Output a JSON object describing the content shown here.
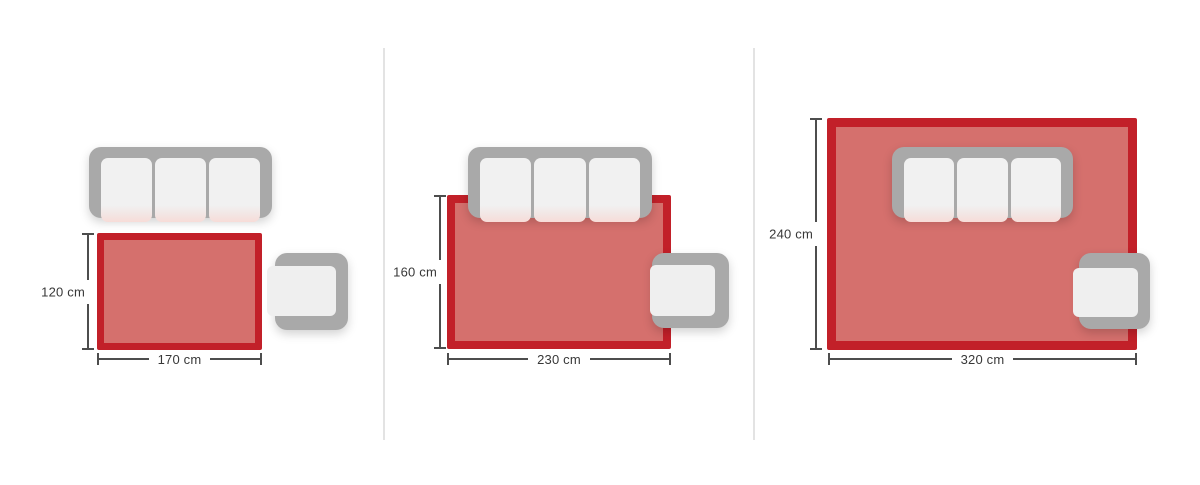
{
  "panels": [
    {
      "id": "rug-small",
      "width_label": "170 cm",
      "height_label": "120 cm",
      "rug_width_cm": 170,
      "rug_height_cm": 120
    },
    {
      "id": "rug-medium",
      "width_label": "230 cm",
      "height_label": "160 cm",
      "rug_width_cm": 230,
      "rug_height_cm": 160
    },
    {
      "id": "rug-large",
      "width_label": "320 cm",
      "height_label": "240 cm",
      "rug_width_cm": 320,
      "rug_height_cm": 240
    }
  ],
  "colors": {
    "rug_border": "#c22029",
    "rug_fill": "#d5706d",
    "furniture": "#a9a9a9",
    "cushion": "#f1f1f1",
    "seat": "#efefef",
    "dim": "#4d4d4d",
    "text": "#383838",
    "divider": "#e3e3e3",
    "bg": "#ffffff"
  }
}
